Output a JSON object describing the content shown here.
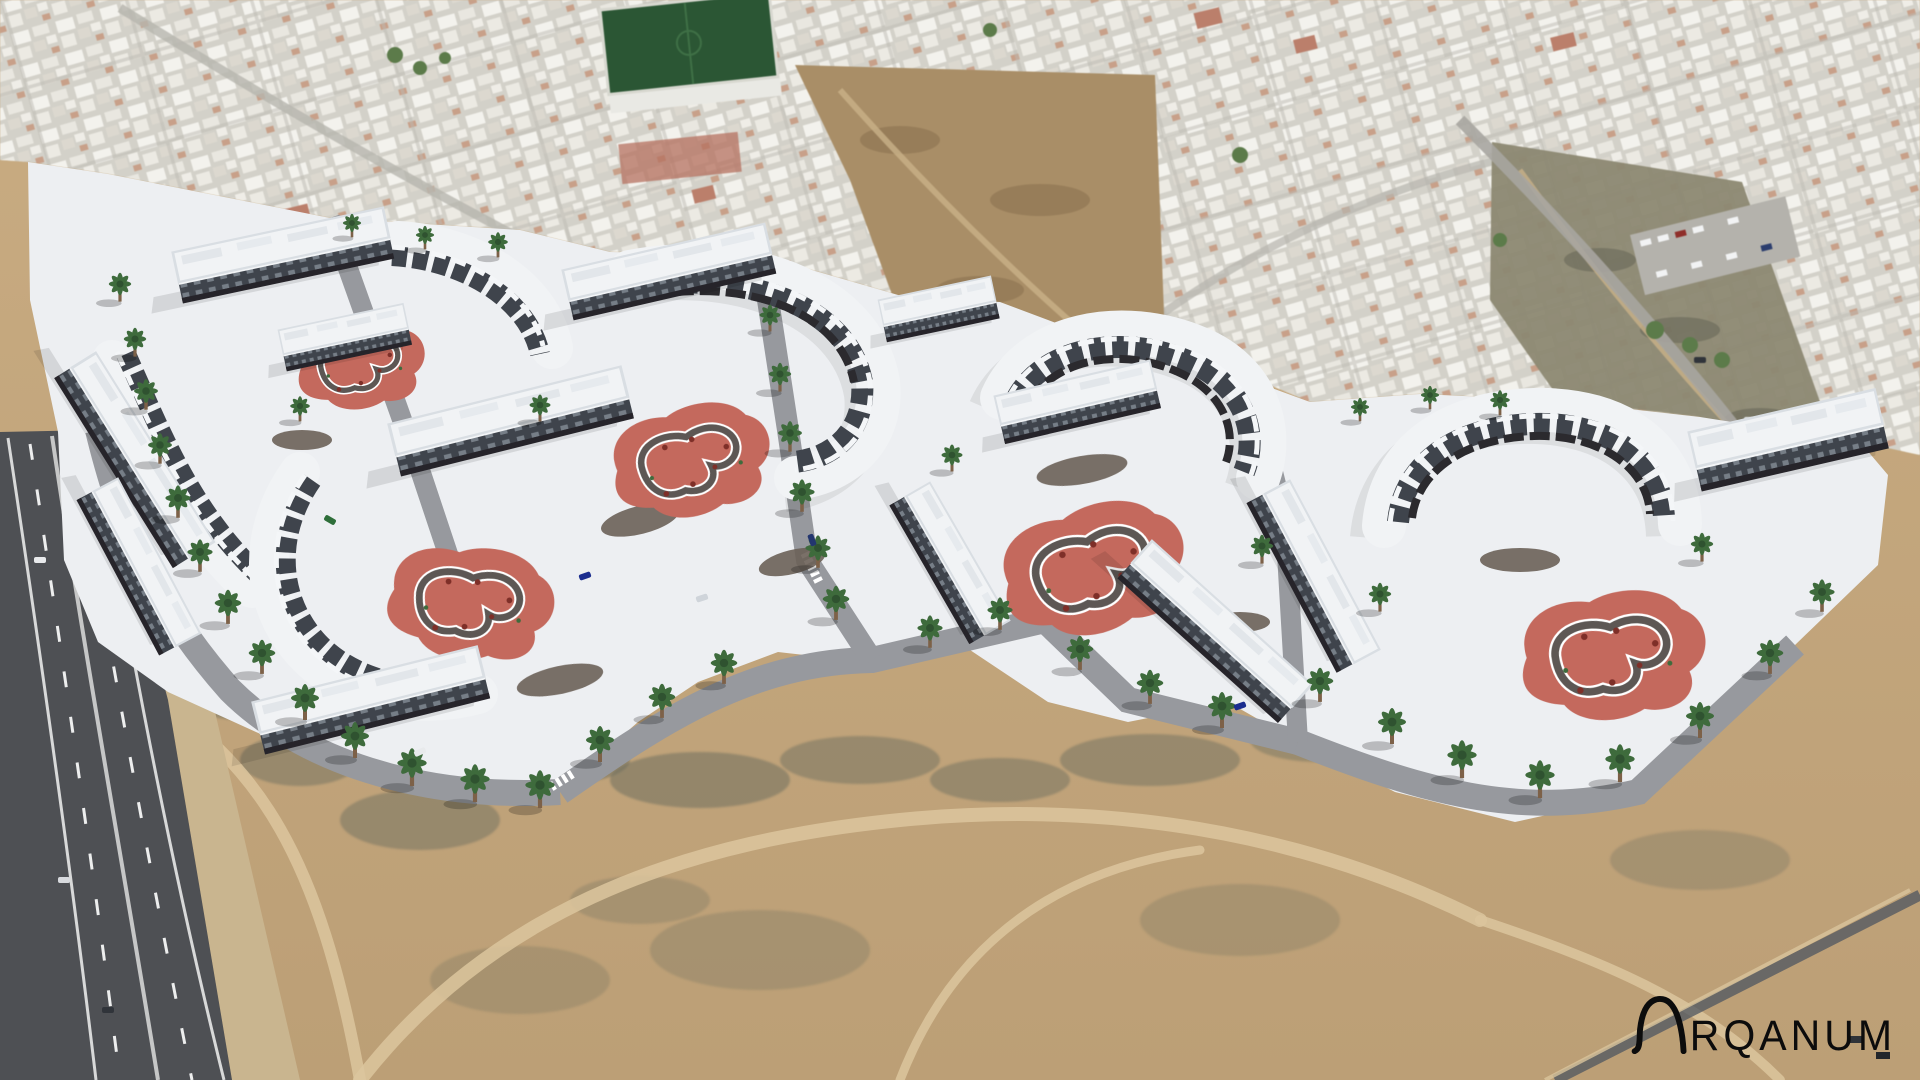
{
  "logo": {
    "brand": "ARQANUM",
    "visible_wordmark": "RQANUM",
    "color": "#0c0c0c"
  },
  "scene": {
    "alt": "Aerial 3D render of a white low-rise apartment development with five salmon courtyard playgrounds, palm-lined streets and white plazas, set between a dense white town above and open desert land below, beside a highway on the left. ARQANUM watermark at bottom right.",
    "courtyard_playgrounds": 5,
    "watermark": "ARQANUM"
  },
  "palette": {
    "building_white": "#f1f3f5",
    "facade_dark": "#3f444c",
    "plaza_white": "#edeff2",
    "street_gray": "#97999e",
    "playground_salmon": "#c4695d",
    "playground_path": "#5d5754",
    "palm_green": "#3e6b3c",
    "trunk_brown": "#7d6148",
    "desert_sand": "#c7aa80",
    "urban_light": "#d3d1c9",
    "field_green": "#2b5634",
    "road_asphalt": "#4e5054",
    "dirt_brown": "#a98e67",
    "logo_black": "#0c0c0c"
  }
}
